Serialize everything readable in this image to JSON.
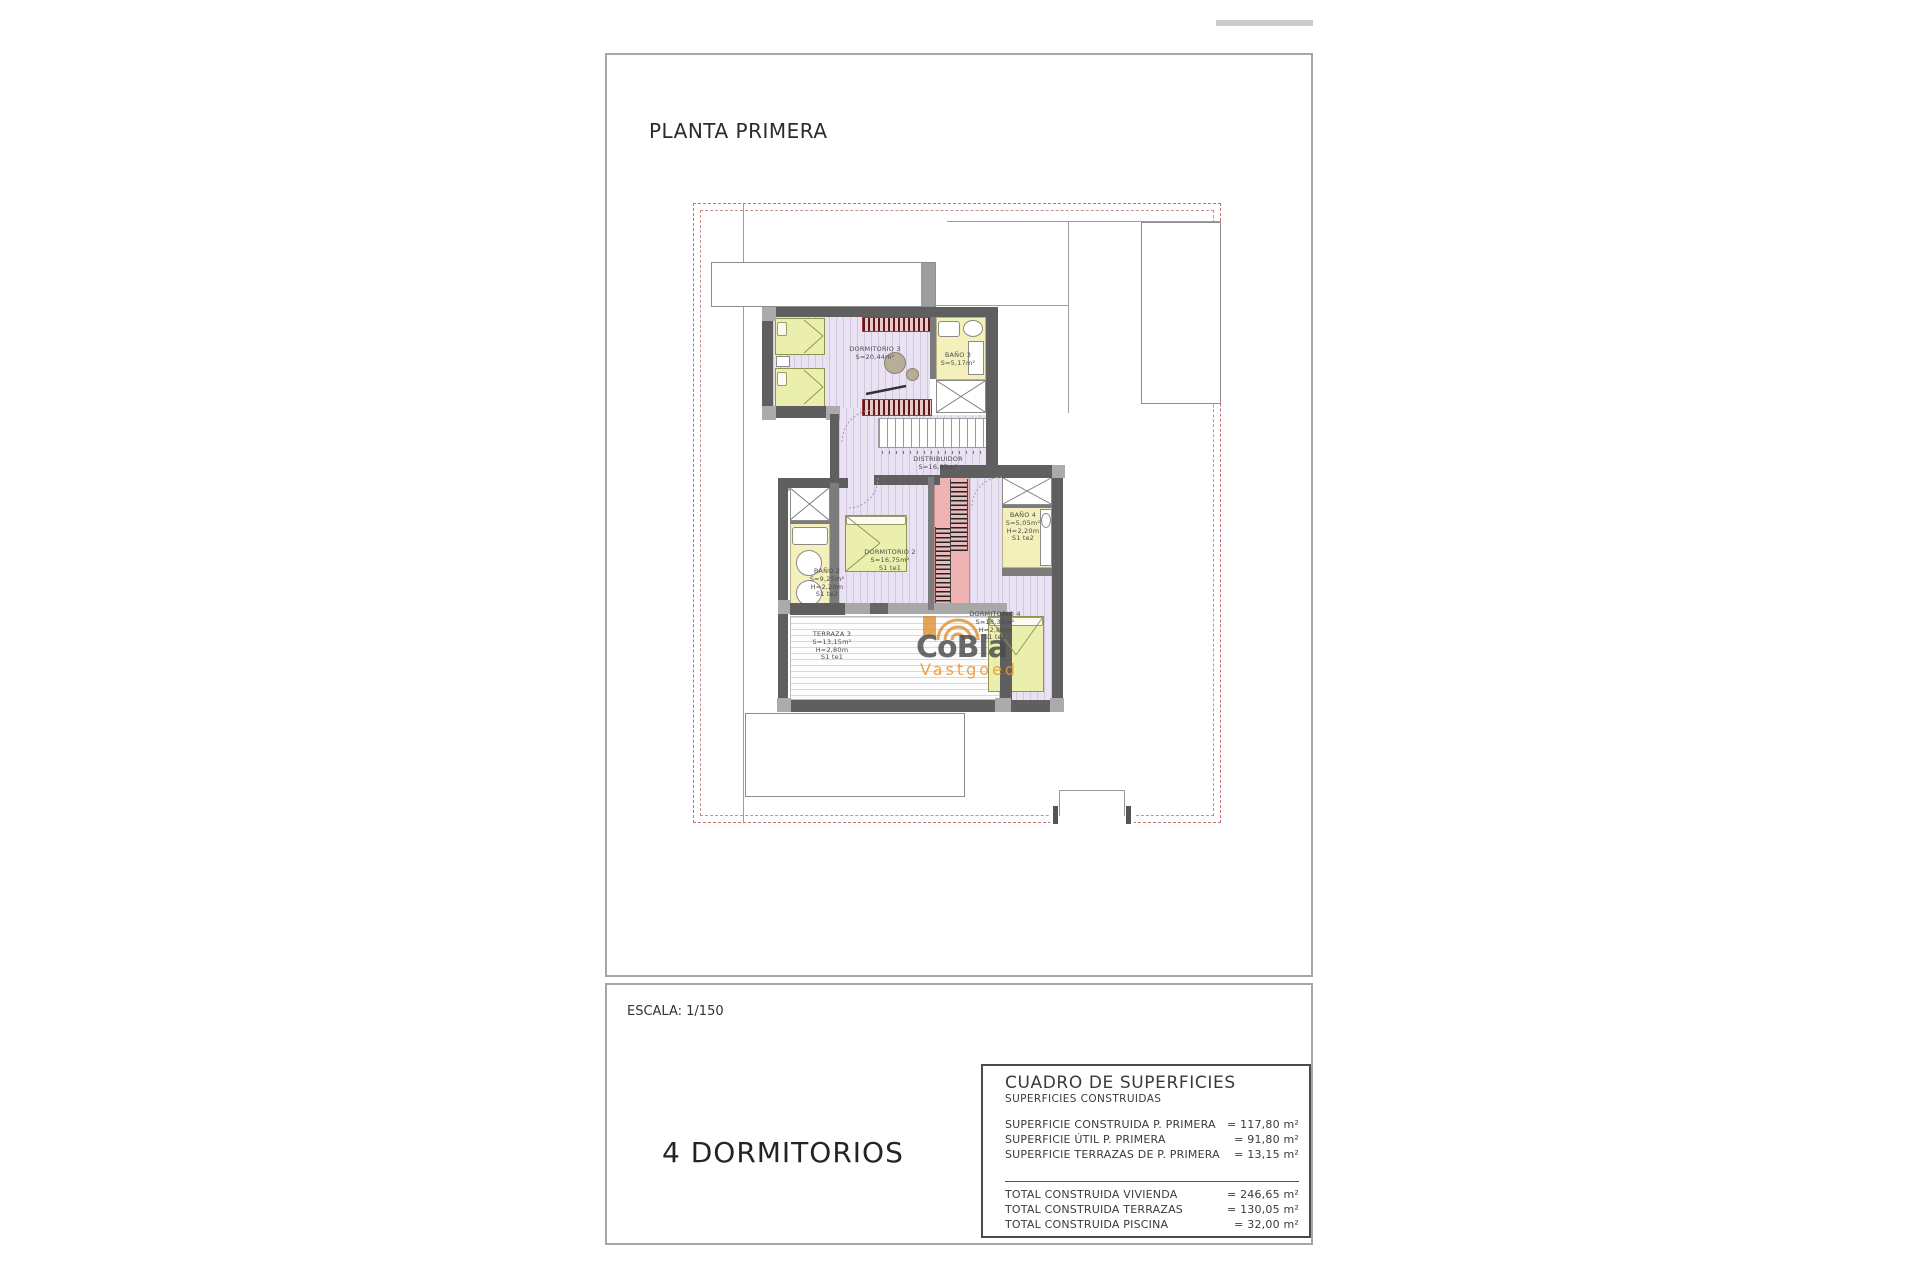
{
  "sheet": {
    "title": "PLANTA PRIMERA",
    "scale": "ESCALA: 1/150",
    "bedrooms": "4 DORMITORIOS"
  },
  "watermark": {
    "brand": "CoBla",
    "tagline": "Vastgoed"
  },
  "plan": {
    "rooms": [
      {
        "name": "DORMITORIO 3",
        "area": "S=20,44m²"
      },
      {
        "name": "BAÑO 3",
        "area": "S=5,17m²"
      },
      {
        "name": "DISTRIBUIDOR",
        "area": "S=16,85m²"
      },
      {
        "name": "DORMITORIO 2",
        "area": "S=16,75m²",
        "note": "S1 te1"
      },
      {
        "name": "BAÑO 2",
        "area": "S=9,25m²",
        "height": "H=2,20m",
        "note": "S1 te2"
      },
      {
        "name": "BAÑO 4",
        "area": "S=5,05m²",
        "height": "H=2,20m",
        "note": "S1 te2"
      },
      {
        "name": "DORMITORIO 4",
        "area": "S=18,35m²",
        "height": "H=2,80m",
        "note": "S1 te1"
      },
      {
        "name": "TERRAZA 3",
        "area": "S=13,15m²",
        "height": "H=2,80m",
        "note": "S1 te1"
      }
    ]
  },
  "surfaces": {
    "title": "CUADRO DE SUPERFICIES",
    "subtitle": "SUPERFICIES CONSTRUIDAS",
    "rows": [
      {
        "label": "SUPERFICIE CONSTRUIDA P. PRIMERA",
        "value": "= 117,80 m²"
      },
      {
        "label": "SUPERFICIE ÚTIL P. PRIMERA",
        "value": "= 91,80 m²"
      },
      {
        "label": "SUPERFICIE TERRAZAS DE P. PRIMERA",
        "value": "= 13,15 m²"
      }
    ],
    "totals": [
      {
        "label": "TOTAL CONSTRUIDA VIVIENDA",
        "value": "= 246,65 m²"
      },
      {
        "label": "TOTAL CONSTRUIDA TERRAZAS",
        "value": "= 130,05 m²"
      },
      {
        "label": "TOTAL CONSTRUIDA PISCINA",
        "value": "= 32,00 m²"
      }
    ]
  },
  "colors": {
    "boundary_dash": "#c4706f",
    "floor_lavender": "#e9e2f2",
    "wet_room_yellow": "#f3f0bb",
    "stair_pink": "#f0b3b3",
    "wall_gray": "#5f5f5f",
    "watermark_accent": "#dd8f2e"
  }
}
